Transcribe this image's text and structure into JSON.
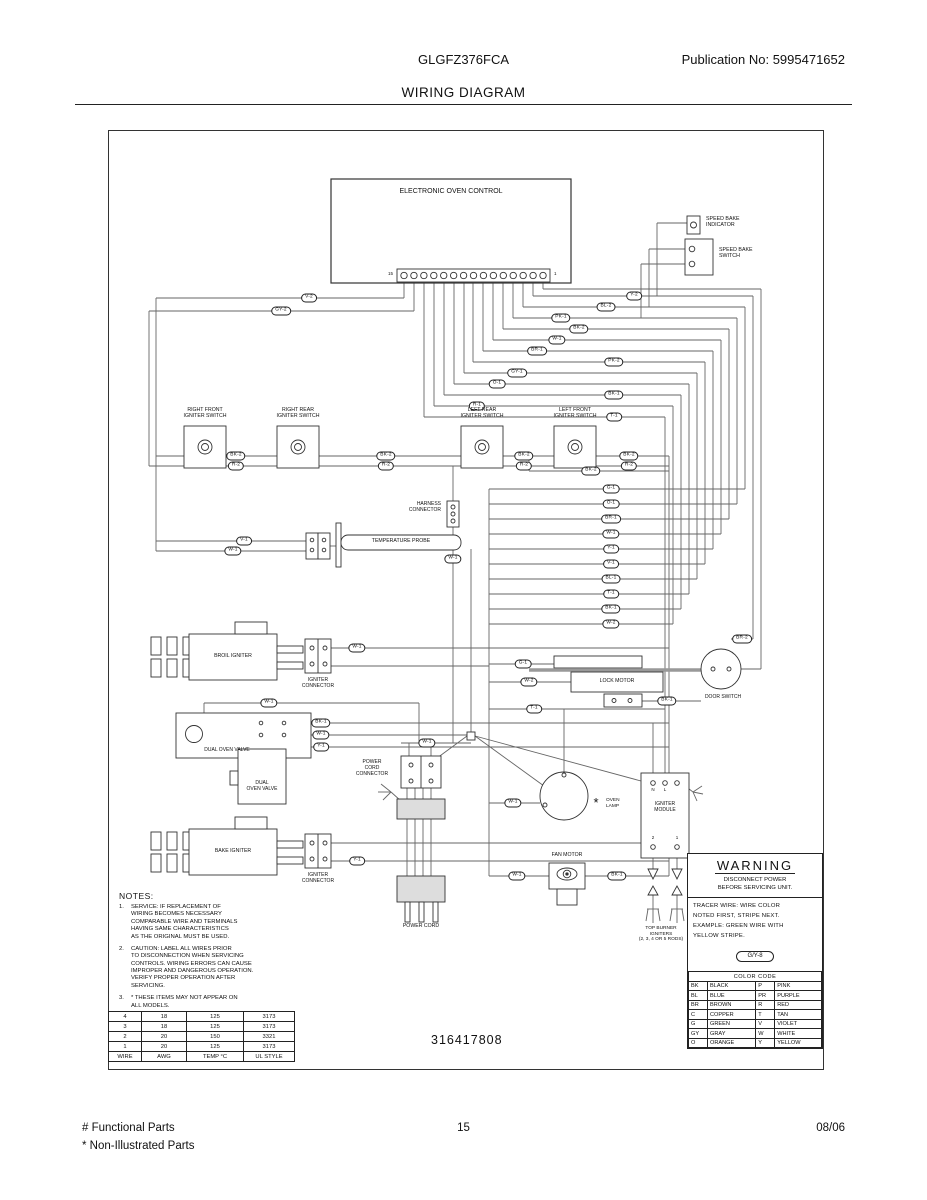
{
  "header": {
    "model": "GLGFZ376FCA",
    "publication": "Publication No: 5995471652",
    "title": "WIRING DIAGRAM"
  },
  "part_number": "316417808",
  "footer": {
    "left1": "# Functional Parts",
    "left2": "* Non-Illustrated Parts",
    "center": "15",
    "right": "08/06"
  },
  "notes": {
    "heading": "NOTES:",
    "items": [
      {
        "num": "1.",
        "text": "SERVICE: IF REPLACEMENT OF\nWIRING BECOMES NECESSARY\nCOMPARABLE WIRE AND TERMINALS\nHAVING SAME CHARACTERISTICS\nAS THE ORIGINAL MUST BE USED."
      },
      {
        "num": "2.",
        "text": "CAUTION: LABEL ALL WIRES PRIOR\nTO DISCONNECTION WHEN SERVICING\nCONTROLS. WIRING ERRORS CAN CAUSE\nIMPROPER AND DANGEROUS OPERATION.\nVERIFY PROPER OPERATION AFTER\nSERVICING."
      },
      {
        "num": "3.",
        "text": "* THESE ITEMS MAY NOT APPEAR ON\nALL MODELS."
      }
    ]
  },
  "warning": {
    "title": "WARNING",
    "subtitle": "DISCONNECT POWER\nBEFORE SERVICING UNIT.",
    "tracer": "TRACER WIRE:  WIRE COLOR\nNOTED FIRST, STRIPE NEXT.\nEXAMPLE:  GREEN WIRE WITH\nYELLOW STRIPE.",
    "example_code": "G/Y-8"
  },
  "color_code": {
    "title": "COLOR CODE",
    "rows": [
      [
        "BK",
        "BLACK",
        "P",
        "PINK"
      ],
      [
        "BL",
        "BLUE",
        "PR",
        "PURPLE"
      ],
      [
        "BR",
        "BROWN",
        "R",
        "RED"
      ],
      [
        "C",
        "COPPER",
        "T",
        "TAN"
      ],
      [
        "G",
        "GREEN",
        "V",
        "VIOLET"
      ],
      [
        "GY",
        "GRAY",
        "W",
        "WHITE"
      ],
      [
        "O",
        "ORANGE",
        "Y",
        "YELLOW"
      ]
    ]
  },
  "wire_table": {
    "rows": [
      [
        "4",
        "18",
        "125",
        "3173"
      ],
      [
        "3",
        "18",
        "125",
        "3173"
      ],
      [
        "2",
        "20",
        "150",
        "3321"
      ],
      [
        "1",
        "20",
        "125",
        "3173"
      ],
      [
        "WIRE",
        "AWG",
        "TEMP °C",
        "UL STYLE"
      ]
    ]
  },
  "diagram": {
    "terminal_strip": {
      "count": 15,
      "x0": 295,
      "dx": 9.93,
      "y": 144.5,
      "left_label": "15",
      "right_label": "1"
    },
    "rows": [
      [
        165,
        424,
        644,
        "Y-2",
        525
      ],
      [
        176,
        414,
        636,
        "BL-2",
        497
      ],
      [
        187,
        404,
        628,
        "PK-1",
        452
      ],
      [
        198,
        394,
        620,
        "BK-2",
        470
      ],
      [
        209,
        384,
        612,
        "W-1",
        448
      ],
      [
        220,
        374,
        604,
        "BR-1",
        428
      ],
      [
        231,
        364,
        596,
        "PK-2",
        505
      ],
      [
        242,
        355,
        588,
        "GY-1",
        408
      ],
      [
        253,
        345,
        580,
        "O-1",
        388
      ],
      [
        264,
        335,
        572,
        "BK-1",
        505
      ],
      [
        275,
        325,
        564,
        "R-1",
        368
      ],
      [
        286,
        315,
        556,
        "T-1",
        505
      ],
      [
        167,
        47,
        295,
        "V-2",
        200
      ],
      [
        180,
        40,
        305,
        "GY-2",
        172
      ],
      [
        358,
        380,
        636,
        "G-1",
        502
      ],
      [
        373,
        380,
        628,
        "O-1",
        502
      ],
      [
        388,
        380,
        620,
        "BR-1",
        502
      ],
      [
        403,
        380,
        612,
        "W-1",
        502
      ],
      [
        418,
        380,
        604,
        "Y-1",
        502
      ],
      [
        433,
        380,
        596,
        "V-1",
        502
      ],
      [
        448,
        380,
        588,
        "BL-1",
        502
      ],
      [
        463,
        380,
        580,
        "T-1",
        502
      ],
      [
        478,
        380,
        572,
        "BK-1",
        502
      ],
      [
        493,
        380,
        564,
        "W-2",
        502
      ],
      [
        340,
        420,
        560,
        "BK-2",
        482
      ],
      [
        410,
        47,
        197,
        "V-1",
        135
      ],
      [
        420,
        47,
        197,
        "W-1",
        124
      ],
      [
        517,
        221,
        560,
        "W-1",
        248
      ],
      [
        730,
        221,
        560,
        "Y-1",
        248
      ],
      [
        572,
        95,
        310,
        "W-1",
        160
      ],
      [
        592,
        180,
        560,
        "BK-1",
        212
      ],
      [
        604,
        180,
        358,
        "W-1",
        212
      ],
      [
        616,
        177,
        560,
        "Y-1",
        212
      ],
      [
        612,
        292,
        362,
        "W-1",
        318
      ],
      [
        533,
        380,
        445,
        "G-1",
        414
      ],
      [
        551,
        380,
        462,
        "W-2",
        420
      ],
      [
        570,
        533,
        592,
        "BK-1",
        558
      ],
      [
        508,
        622,
        644,
        "BR-2",
        633
      ],
      [
        578,
        380,
        556,
        "T-1",
        425
      ],
      [
        672,
        380,
        431,
        "W-1",
        404
      ],
      [
        745,
        380,
        440,
        "W-1",
        408
      ],
      [
        745,
        476,
        560,
        "BK-1",
        508
      ]
    ],
    "ovals": [
      {
        "c": "BK-2",
        "x": 127,
        "y": 325
      },
      {
        "c": "BK-2",
        "x": 277,
        "y": 325
      },
      {
        "c": "BK-2",
        "x": 415,
        "y": 325
      },
      {
        "c": "BK-2",
        "x": 520,
        "y": 325
      },
      {
        "c": "R-2",
        "x": 127,
        "y": 335
      },
      {
        "c": "R-2",
        "x": 277,
        "y": 335
      },
      {
        "c": "R-2",
        "x": 415,
        "y": 335
      },
      {
        "c": "R-2",
        "x": 520,
        "y": 335
      },
      {
        "c": "W-1",
        "x": 344,
        "y": 428
      }
    ],
    "cols": [
      [
        295,
        152,
        167
      ],
      [
        305,
        152,
        180
      ],
      [
        315,
        152,
        286
      ],
      [
        325,
        152,
        275
      ],
      [
        335,
        152,
        264
      ],
      [
        345,
        152,
        253
      ],
      [
        355,
        152,
        242
      ],
      [
        364,
        152,
        231
      ],
      [
        374,
        152,
        220
      ],
      [
        384,
        152,
        209
      ],
      [
        394,
        152,
        198
      ],
      [
        404,
        152,
        187
      ],
      [
        414,
        152,
        176
      ],
      [
        424,
        152,
        165
      ],
      [
        434,
        152,
        158
      ],
      [
        652,
        158,
        538
      ],
      [
        644,
        165,
        508
      ],
      [
        636,
        176,
        358
      ],
      [
        628,
        187,
        373
      ],
      [
        620,
        198,
        388
      ],
      [
        612,
        209,
        403
      ],
      [
        604,
        220,
        418
      ],
      [
        596,
        231,
        433
      ],
      [
        588,
        242,
        448
      ],
      [
        580,
        253,
        463
      ],
      [
        572,
        264,
        478
      ],
      [
        564,
        275,
        493
      ],
      [
        556,
        286,
        652
      ],
      [
        47,
        167,
        420
      ],
      [
        40,
        180,
        335
      ],
      [
        560,
        325,
        745
      ],
      [
        420,
        325,
        340
      ],
      [
        380,
        358,
        745
      ],
      [
        362,
        418,
        601
      ],
      [
        344,
        335,
        370
      ],
      [
        344,
        396,
        612
      ],
      [
        310,
        572,
        612
      ],
      [
        300,
        612,
        625
      ],
      [
        322,
        612,
        625
      ],
      [
        95,
        572,
        582
      ],
      [
        544,
        592,
        650
      ],
      [
        455,
        578,
        641
      ],
      [
        298,
        657,
        745
      ],
      [
        306,
        657,
        745
      ],
      [
        314,
        657,
        745
      ],
      [
        322,
        657,
        745
      ],
      [
        548,
        92,
        165
      ],
      [
        540,
        118,
        176
      ],
      [
        532,
        133,
        187
      ],
      [
        544,
        727,
        738
      ],
      [
        568,
        727,
        738
      ],
      [
        544,
        764,
        778
      ],
      [
        568,
        764,
        778
      ]
    ],
    "segments": [
      [
        434,
        158,
        652,
        158
      ],
      [
        578,
        92,
        548,
        92
      ],
      [
        576,
        118,
        540,
        118
      ],
      [
        576,
        133,
        532,
        133
      ],
      [
        221,
        535,
        380,
        535
      ],
      [
        221,
        712,
        560,
        712
      ],
      [
        47,
        325,
        560,
        325
      ],
      [
        40,
        335,
        560,
        335
      ],
      [
        622,
        538,
        652,
        538
      ],
      [
        221,
        415,
        229,
        415
      ],
      [
        366,
        605,
        435,
        655
      ],
      [
        366,
        605,
        532,
        650
      ],
      [
        358,
        605,
        324,
        630
      ],
      [
        292,
        670,
        282,
        661
      ],
      [
        282,
        661,
        272,
        653
      ],
      [
        282,
        661,
        269,
        661
      ],
      [
        282,
        661,
        274,
        669
      ],
      [
        571,
        651,
        584,
        661
      ],
      [
        584,
        661,
        593,
        655
      ],
      [
        584,
        661,
        594,
        663
      ],
      [
        584,
        661,
        588,
        670
      ],
      [
        538,
        778,
        550,
        778
      ],
      [
        539,
        778,
        537,
        790
      ],
      [
        544,
        778,
        544,
        792
      ],
      [
        549,
        778,
        551,
        790
      ],
      [
        562,
        778,
        574,
        778
      ],
      [
        563,
        778,
        561,
        790
      ],
      [
        568,
        778,
        568,
        792
      ],
      [
        573,
        778,
        575,
        790
      ]
    ],
    "texts": [
      {
        "n": "eoc-label",
        "t": "ELECTRONIC OVEN CONTROL",
        "x": 342,
        "y": 57,
        "s": 7
      },
      {
        "n": "speed-bake-indicator-label",
        "t": "SPEED BAKE\nINDICATOR",
        "x": 597,
        "y": 85,
        "s": 5.3,
        "a": "left"
      },
      {
        "n": "speed-bake-switch-label",
        "t": "SPEED BAKE\nSWITCH",
        "x": 610,
        "y": 116,
        "s": 5.3,
        "a": "left"
      },
      {
        "n": "right-front-igniter-switch-label",
        "t": "RIGHT FRONT\nIGNITER SWITCH",
        "x": 96,
        "y": 276,
        "s": 5.2
      },
      {
        "n": "right-rear-igniter-switch-label",
        "t": "RIGHT REAR\nIGNITER SWITCH",
        "x": 189,
        "y": 276,
        "s": 5.2
      },
      {
        "n": "left-rear-igniter-switch-label",
        "t": "LEFT REAR\nIGNITER SWITCH",
        "x": 373,
        "y": 276,
        "s": 5.2
      },
      {
        "n": "left-front-igniter-switch-label",
        "t": "LEFT FRONT\nIGNITER SWITCH",
        "x": 466,
        "y": 276,
        "s": 5.2
      },
      {
        "n": "harness-connector-label",
        "t": "HARNESS\nCONNECTOR",
        "x": 332,
        "y": 371,
        "s": 5,
        "a": "right"
      },
      {
        "n": "temperature-probe-label",
        "t": "TEMPERATURE PROBE",
        "x": 292,
        "y": 407,
        "s": 5.2
      },
      {
        "n": "broil-igniter-label",
        "t": "BROIL IGNITER",
        "x": 124,
        "y": 522,
        "s": 5.2
      },
      {
        "n": "igniter-connector-1-label",
        "t": "IGNITER\nCONNECTOR",
        "x": 209,
        "y": 547,
        "s": 5
      },
      {
        "n": "dual-oven-valve-1-label",
        "t": "DUAL OVEN VALVE",
        "x": 118,
        "y": 617,
        "s": 5
      },
      {
        "n": "dual-oven-valve-2-label",
        "t": "DUAL\nOVEN VALVE",
        "x": 153,
        "y": 650,
        "s": 5
      },
      {
        "n": "bake-igniter-label",
        "t": "BAKE IGNITER",
        "x": 124,
        "y": 717,
        "s": 5.2
      },
      {
        "n": "igniter-connector-2-label",
        "t": "IGNITER\nCONNECTOR",
        "x": 209,
        "y": 742,
        "s": 5
      },
      {
        "n": "power-cord-connector-label",
        "t": "POWER\nCORD\nCONNECTOR",
        "x": 263,
        "y": 629,
        "s": 5
      },
      {
        "n": "power-cord-label",
        "t": "POWER CORD",
        "x": 312,
        "y": 792,
        "s": 5.2
      },
      {
        "n": "lock-motor-label",
        "t": "LOCK MOTOR",
        "x": 508,
        "y": 547,
        "s": 5.2
      },
      {
        "n": "door-switch-label",
        "t": "DOOR SWITCH",
        "x": 614,
        "y": 564,
        "s": 5
      },
      {
        "n": "oven-lamp-asterisk",
        "t": "*",
        "x": 487,
        "y": 664,
        "s": 13
      },
      {
        "n": "oven-lamp-label",
        "t": "OVEN\nLAMP",
        "x": 497,
        "y": 667,
        "s": 4.8,
        "a": "left"
      },
      {
        "n": "igniter-module-label",
        "t": "IGNITER\nMODULE",
        "x": 556,
        "y": 671,
        "s": 5
      },
      {
        "n": "module-terminal-n",
        "t": "N",
        "x": 544,
        "y": 656,
        "s": 4.5
      },
      {
        "n": "module-terminal-l",
        "t": "L",
        "x": 556,
        "y": 656,
        "s": 4.5
      },
      {
        "n": "module-terminal-2",
        "t": "2",
        "x": 544,
        "y": 704,
        "s": 4.5
      },
      {
        "n": "module-terminal-1",
        "t": "1",
        "x": 568,
        "y": 704,
        "s": 4.5
      },
      {
        "n": "fan-motor-label",
        "t": "FAN MOTOR",
        "x": 458,
        "y": 721,
        "s": 5.2
      },
      {
        "n": "top-burner-igniters-label",
        "t": "TOP BURNER\nIGNITERS\n(2, 3, 4 OR 5 RODS)",
        "x": 552,
        "y": 795,
        "s": 4.8
      },
      {
        "n": "strip-left-terminal-number",
        "t": "15",
        "x": 284,
        "y": 140,
        "s": 4.5,
        "a": "right"
      },
      {
        "n": "strip-right-terminal-number",
        "t": "1",
        "x": 445,
        "y": 140,
        "s": 4.5,
        "a": "left"
      }
    ]
  }
}
